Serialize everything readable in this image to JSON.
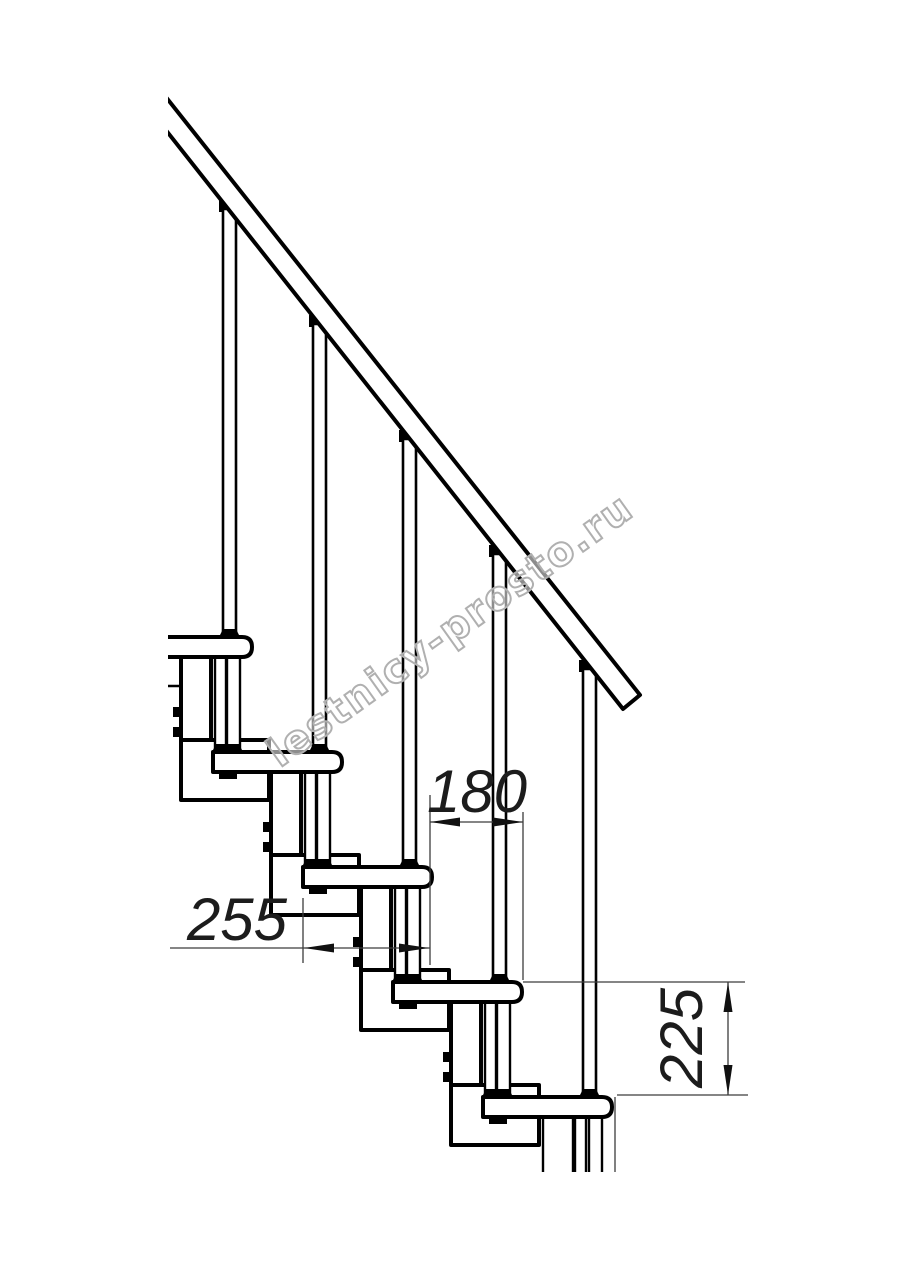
{
  "dimensions": {
    "step_run": "180",
    "tread_depth": "255",
    "step_rise": "225"
  },
  "watermark": {
    "text": "lestnicy-prosto.ru"
  },
  "colors": {
    "line": "#000000",
    "dimension_line": "#3c3c3c",
    "dimension_text": "#1c1c1c",
    "watermark_stroke": "#b0b0b0",
    "background": "#ffffff"
  }
}
